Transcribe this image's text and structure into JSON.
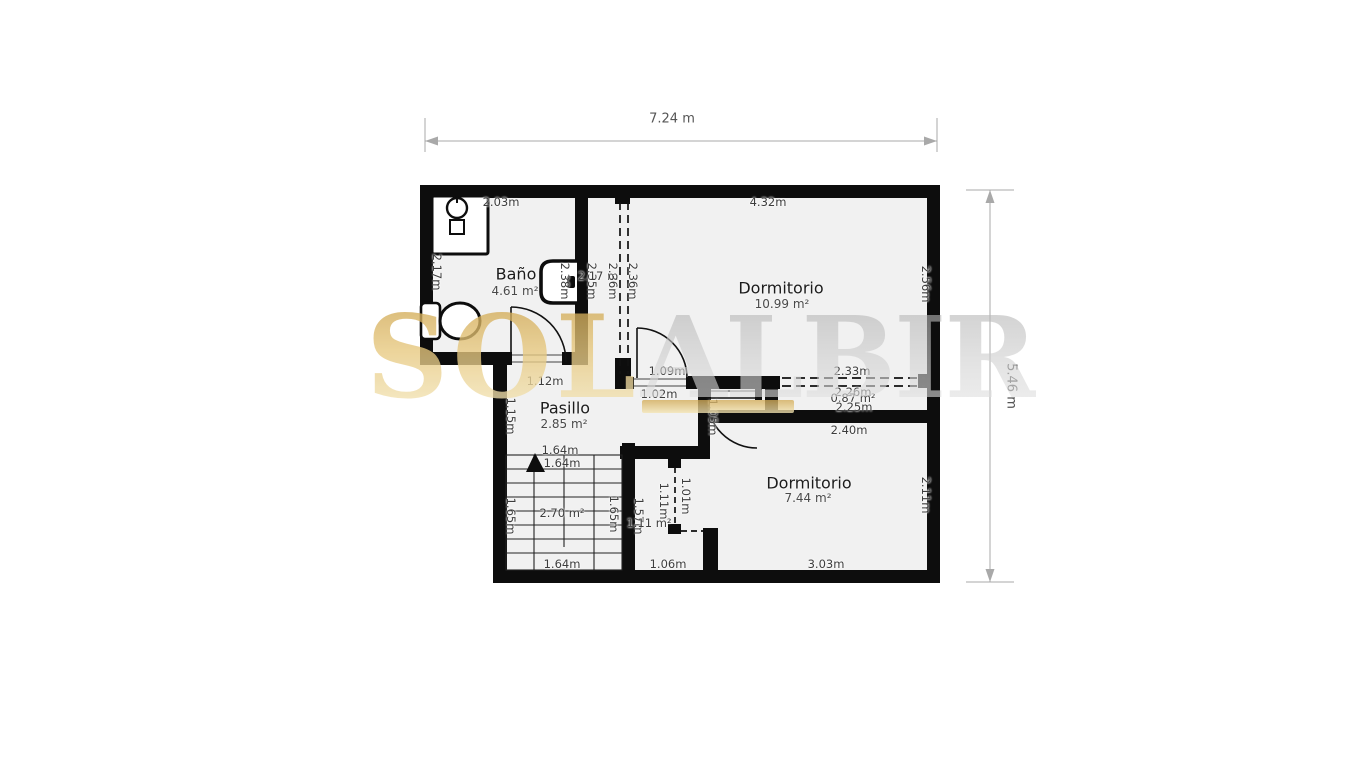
{
  "plan": {
    "overall_width_label": "7.24 m",
    "overall_height_label": "5.46 m"
  },
  "watermark": {
    "left_text": "SOL",
    "right_text": "ALBIR",
    "gold_color": "#e7c87e",
    "gray_color": "#cfcfcf"
  },
  "rooms": {
    "bano": {
      "name": "Baño",
      "area": "4.61 m²"
    },
    "bed1": {
      "name": "Dormitorio",
      "area": "10.99 m²"
    },
    "pasillo": {
      "name": "Pasillo",
      "area": "2.85 m²"
    },
    "bed2": {
      "name": "Dormitorio",
      "area": "7.44 m²"
    }
  },
  "dim_labels": [
    {
      "t": "2.03m",
      "x": 501,
      "y": 202,
      "v": 0
    },
    {
      "t": "4.32m",
      "x": 768,
      "y": 202,
      "v": 0
    },
    {
      "t": "2.17m",
      "x": 437,
      "y": 272,
      "v": 1
    },
    {
      "t": "2.38m",
      "x": 565,
      "y": 281,
      "v": 1
    },
    {
      "t": "2.35m",
      "x": 592,
      "y": 281,
      "v": 1
    },
    {
      "t": "2.17 m",
      "x": 598,
      "y": 276,
      "v": 0
    },
    {
      "t": "2.36m",
      "x": 613,
      "y": 281,
      "v": 1
    },
    {
      "t": "2.36m",
      "x": 633,
      "y": 281,
      "v": 1
    },
    {
      "t": "2.56m",
      "x": 926,
      "y": 284,
      "v": 1
    },
    {
      "t": "1.12m",
      "x": 545,
      "y": 381,
      "v": 0
    },
    {
      "t": "1.15m",
      "x": 511,
      "y": 416,
      "v": 1
    },
    {
      "t": "1.09m",
      "x": 667,
      "y": 371,
      "v": 0
    },
    {
      "t": "1.02m",
      "x": 659,
      "y": 394,
      "v": 0
    },
    {
      "t": "2.33m",
      "x": 852,
      "y": 371,
      "v": 0
    },
    {
      "t": "2.26m",
      "x": 853,
      "y": 392,
      "v": 0
    },
    {
      "t": "0.87 m²",
      "x": 853,
      "y": 398,
      "v": 0
    },
    {
      "t": "2.25m",
      "x": 854,
      "y": 407,
      "v": 0
    },
    {
      "t": "1.05m",
      "x": 713,
      "y": 417,
      "v": 1
    },
    {
      "t": "2.40m",
      "x": 849,
      "y": 430,
      "v": 0
    },
    {
      "t": "2.11m",
      "x": 926,
      "y": 495,
      "v": 1
    },
    {
      "t": "1.64m",
      "x": 560,
      "y": 450,
      "v": 0
    },
    {
      "t": "1.64m",
      "x": 562,
      "y": 463,
      "v": 0
    },
    {
      "t": "1.65m",
      "x": 511,
      "y": 516,
      "v": 1
    },
    {
      "t": "2.70 m²",
      "x": 562,
      "y": 513,
      "v": 0
    },
    {
      "t": "1.65m",
      "x": 614,
      "y": 514,
      "v": 1
    },
    {
      "t": "1.57m",
      "x": 639,
      "y": 516,
      "v": 1
    },
    {
      "t": "1.11 m²",
      "x": 649,
      "y": 523,
      "v": 0
    },
    {
      "t": "1.11m",
      "x": 664,
      "y": 501,
      "v": 1
    },
    {
      "t": "1.01m",
      "x": 686,
      "y": 496,
      "v": 1
    },
    {
      "t": "1.64m",
      "x": 562,
      "y": 564,
      "v": 0
    },
    {
      "t": "1.06m",
      "x": 668,
      "y": 564,
      "v": 0
    },
    {
      "t": "3.03m",
      "x": 826,
      "y": 564,
      "v": 0
    }
  ]
}
